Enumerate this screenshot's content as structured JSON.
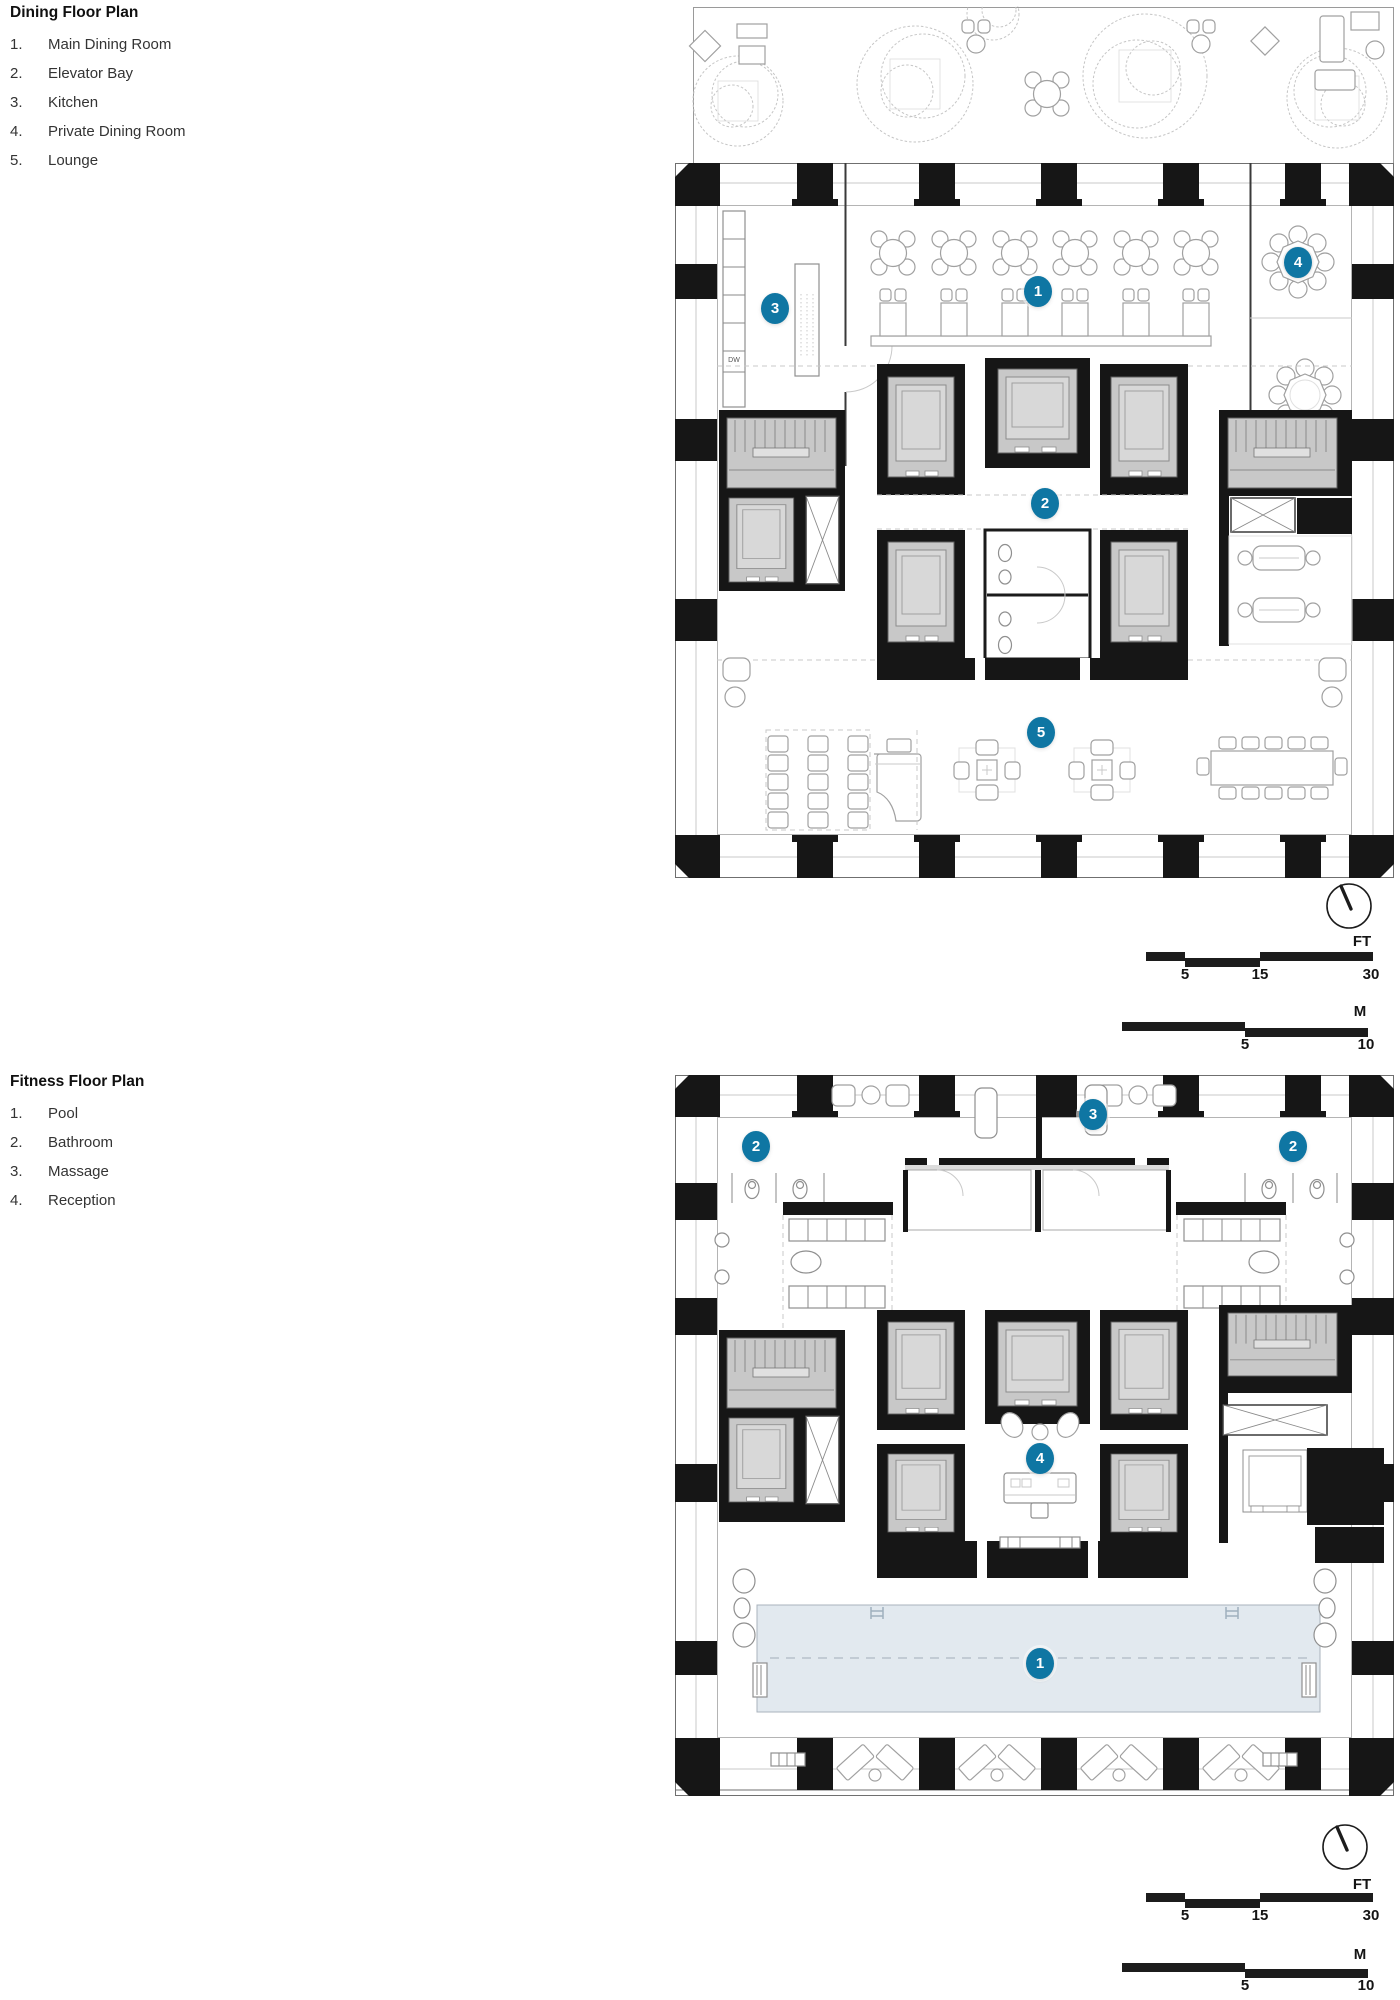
{
  "colors": {
    "accent": "#0f76a3",
    "pool": "#e2e9ef",
    "wall": "#161616"
  },
  "dining": {
    "title": "Dining Floor Plan",
    "legend": [
      {
        "num": "1.",
        "label": "Main Dining Room"
      },
      {
        "num": "2.",
        "label": "Elevator Bay"
      },
      {
        "num": "3.",
        "label": "Kitchen"
      },
      {
        "num": "4.",
        "label": "Private Dining Room"
      },
      {
        "num": "5.",
        "label": "Lounge"
      }
    ],
    "markers": [
      "1",
      "2",
      "3",
      "4",
      "5"
    ],
    "kitchen_dw": "DW"
  },
  "fitness": {
    "title": "Fitness Floor Plan",
    "legend": [
      {
        "num": "1.",
        "label": "Pool"
      },
      {
        "num": "2.",
        "label": "Bathroom"
      },
      {
        "num": "3.",
        "label": "Massage"
      },
      {
        "num": "4.",
        "label": "Reception"
      }
    ],
    "markers": {
      "pool": "1",
      "bathroom": "2",
      "massage": "3",
      "reception": "4"
    }
  },
  "scale": {
    "ft_unit": "FT",
    "ft_ticks": [
      "5",
      "15",
      "30"
    ],
    "m_unit": "M",
    "m_ticks": [
      "5",
      "10"
    ]
  }
}
